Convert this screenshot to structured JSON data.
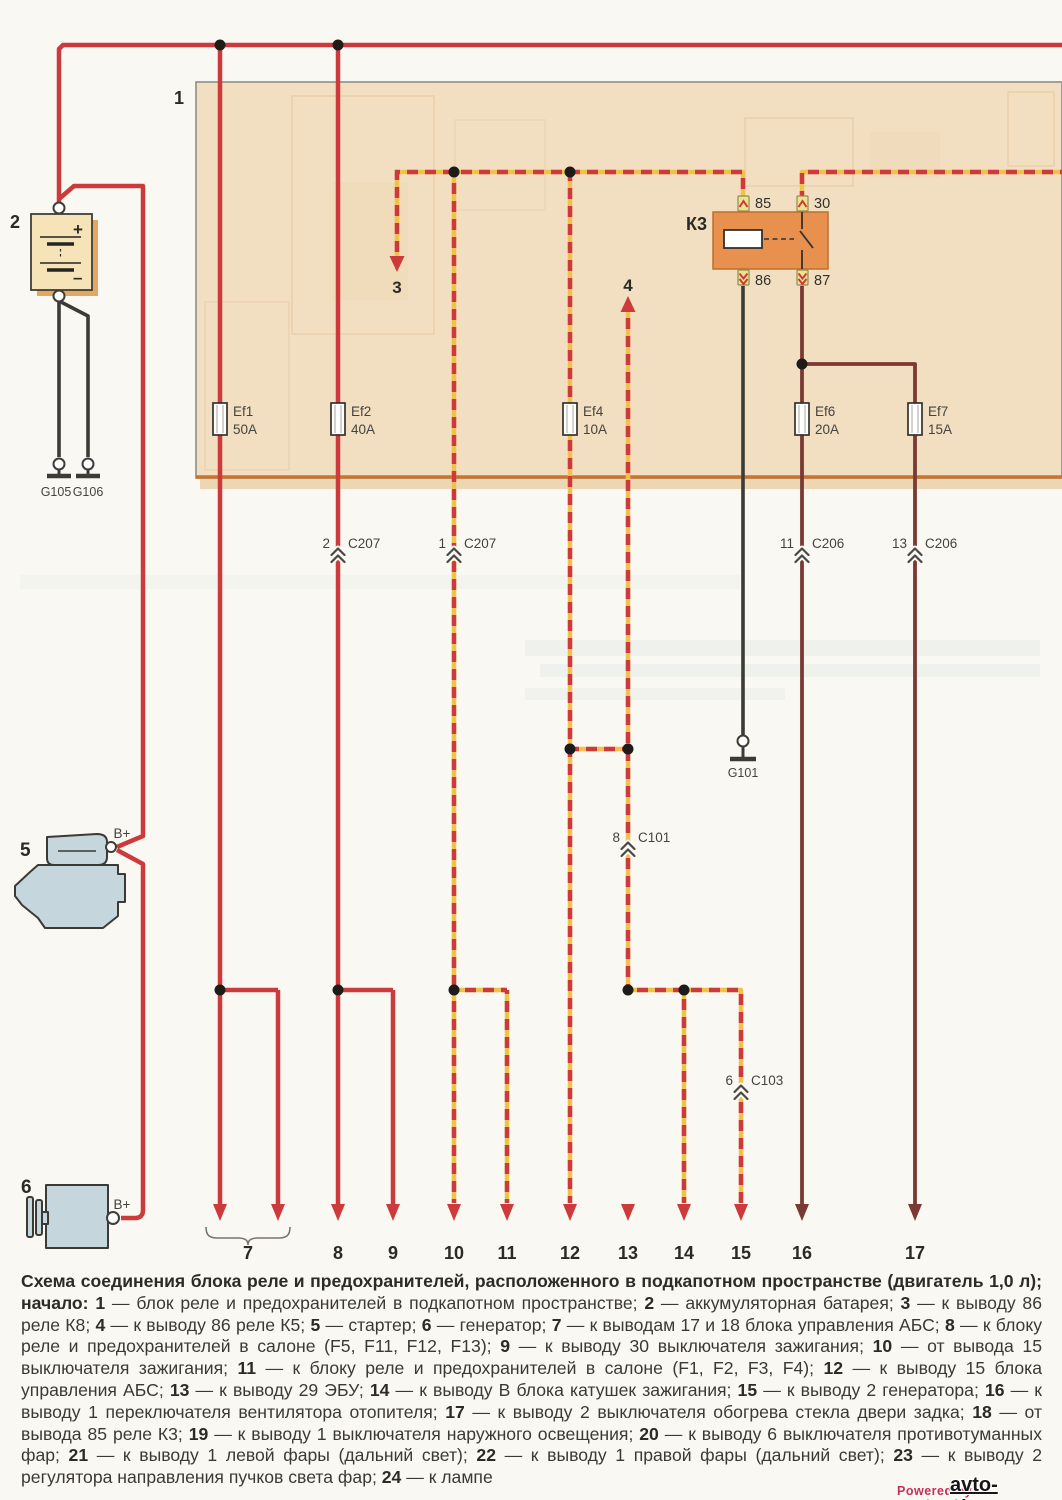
{
  "colors": {
    "wire_red": "#CC3A3C",
    "wire_yellow": "#F0C24B",
    "wire_brown": "#7A3A33",
    "wire_black": "#3C3B35",
    "fusebox_fill": "#F2DFC2",
    "relay_fill": "#E8914E",
    "component_fill": "#C5D6DD"
  },
  "fusebox": {
    "label": "1"
  },
  "battery": {
    "label": "2",
    "plus": "+",
    "minus": "–"
  },
  "grounds": {
    "g105": "G105",
    "g106": "G106",
    "g101": "G101"
  },
  "starter": {
    "label": "5",
    "terminal": "B+"
  },
  "generator": {
    "label": "6",
    "terminal": "B+"
  },
  "relay": {
    "label": "К3",
    "pin_85": "85",
    "pin_30": "30",
    "pin_86": "86",
    "pin_87": "87"
  },
  "fuses": [
    {
      "name": "Ef1",
      "rating": "50A"
    },
    {
      "name": "Ef2",
      "rating": "40A"
    },
    {
      "name": "Ef4",
      "rating": "10A"
    },
    {
      "name": "Ef6",
      "rating": "20A"
    },
    {
      "name": "Ef7",
      "rating": "15A"
    }
  ],
  "connectors": [
    {
      "pin": "2",
      "name": "C207"
    },
    {
      "pin": "1",
      "name": "C207"
    },
    {
      "pin": "11",
      "name": "C206"
    },
    {
      "pin": "13",
      "name": "C206"
    },
    {
      "pin": "8",
      "name": "C101"
    },
    {
      "pin": "6",
      "name": "C103"
    }
  ],
  "branch_arrows": {
    "three": "3",
    "four": "4"
  },
  "outputs": [
    "7",
    "8",
    "9",
    "10",
    "11",
    "12",
    "13",
    "14",
    "15",
    "16",
    "17"
  ],
  "caption": {
    "segments": [
      {
        "b": true,
        "t": "Схема соединения блока реле и предохранителей, расположенного в подкапотном пространстве (двигатель 1,0 л); начало: "
      },
      {
        "b": true,
        "t": "1"
      },
      {
        "b": false,
        "t": " — блок реле и предохранителей в подкапотном пространстве; "
      },
      {
        "b": true,
        "t": "2"
      },
      {
        "b": false,
        "t": " — аккумуляторная батарея; "
      },
      {
        "b": true,
        "t": "3"
      },
      {
        "b": false,
        "t": " — к выводу 86 реле К8; "
      },
      {
        "b": true,
        "t": "4"
      },
      {
        "b": false,
        "t": " — к выводу 86 реле К5; "
      },
      {
        "b": true,
        "t": "5"
      },
      {
        "b": false,
        "t": " — стартер; "
      },
      {
        "b": true,
        "t": "6"
      },
      {
        "b": false,
        "t": " — генератор; "
      },
      {
        "b": true,
        "t": "7"
      },
      {
        "b": false,
        "t": " — к выводам 17 и 18 блока управления АБС; "
      },
      {
        "b": true,
        "t": "8"
      },
      {
        "b": false,
        "t": " — к блоку реле и предохранителей в салоне (F5, F11, F12, F13); "
      },
      {
        "b": true,
        "t": "9"
      },
      {
        "b": false,
        "t": " — к выводу 30 выключателя зажигания; "
      },
      {
        "b": true,
        "t": "10"
      },
      {
        "b": false,
        "t": " — от вывода 15 выключателя зажигания; "
      },
      {
        "b": true,
        "t": "11"
      },
      {
        "b": false,
        "t": " — к блоку реле и предохранителей в салоне (F1, F2, F3, F4); "
      },
      {
        "b": true,
        "t": "12"
      },
      {
        "b": false,
        "t": " — к выводу 15 блока управления АБС; "
      },
      {
        "b": true,
        "t": "13"
      },
      {
        "b": false,
        "t": " — к выводу 29 ЭБУ; "
      },
      {
        "b": true,
        "t": "14"
      },
      {
        "b": false,
        "t": " — к выводу В блока катушек зажигания; "
      },
      {
        "b": true,
        "t": "15"
      },
      {
        "b": false,
        "t": " — к выводу 2 генератора; "
      },
      {
        "b": true,
        "t": "16"
      },
      {
        "b": false,
        "t": " — к выводу 1 переключателя вентилятора отопителя; "
      },
      {
        "b": true,
        "t": "17"
      },
      {
        "b": false,
        "t": " — к выводу 2 выключателя обогрева стекла двери задка; "
      },
      {
        "b": true,
        "t": "18"
      },
      {
        "b": false,
        "t": " — от вывода 85 реле К3; "
      },
      {
        "b": true,
        "t": "19"
      },
      {
        "b": false,
        "t": " — к выводу 1 выключателя наружного освещения; "
      },
      {
        "b": true,
        "t": "20"
      },
      {
        "b": false,
        "t": " — к выводу 6 выключателя противотуманных фар; "
      },
      {
        "b": true,
        "t": "21"
      },
      {
        "b": false,
        "t": " — к выводу 1 левой фары (дальний свет); "
      },
      {
        "b": true,
        "t": "22"
      },
      {
        "b": false,
        "t": " — к выводу 1 правой фары (дальний свет); "
      },
      {
        "b": true,
        "t": "23"
      },
      {
        "b": false,
        "t": " — к выводу 2 регулятора направления пучков света фар; "
      },
      {
        "b": true,
        "t": "24"
      },
      {
        "b": false,
        "t": " — к лампе"
      }
    ]
  },
  "footer": {
    "powered": "Powered by FotohostingTV.RU",
    "site": "avto-shema.ru"
  }
}
